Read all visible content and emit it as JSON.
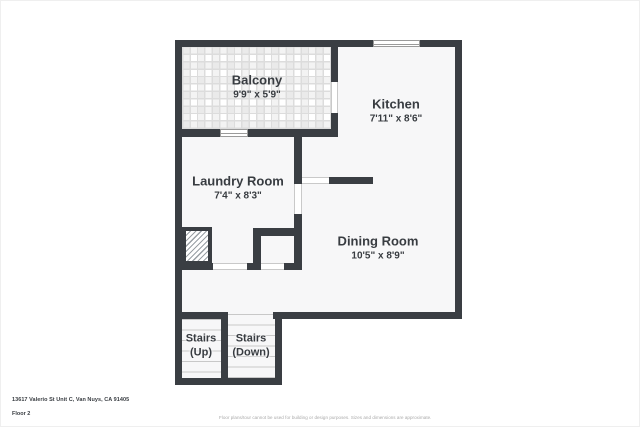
{
  "rooms": {
    "balcony": {
      "label": "Balcony",
      "dims": "9'9\" x 5'9\""
    },
    "kitchen": {
      "label": "Kitchen",
      "dims": "7'11\" x 8'6\""
    },
    "laundry": {
      "label": "Laundry Room",
      "dims": "7'4\" x 8'3\""
    },
    "dining": {
      "label": "Dining Room",
      "dims": "10'5\" x 8'9\""
    },
    "stairs_up": {
      "label": "Stairs",
      "sub": "(Up)"
    },
    "stairs_down": {
      "label": "Stairs",
      "sub": "(Down)"
    }
  },
  "footer": {
    "address": "13617 Valerio St Unit C, Van Nuys, CA 91405",
    "floor_label": "Floor 2",
    "disclaimer": "Floor plans/tour cannot be used for building or design purposes. Sizes and dimensions are approximate."
  },
  "colors": {
    "wall": "#3a3e43",
    "room_fill": "#f7f7f8",
    "label_text": "#383c41",
    "tread_line": "#c8c8c8",
    "tile_grout": "#dcdcdc",
    "hatch_line": "#9aa0a5",
    "window_frame": "#9a9a9a",
    "door_jamb": "#c9c9c9",
    "disclaimer_text": "#a9a9a9"
  }
}
